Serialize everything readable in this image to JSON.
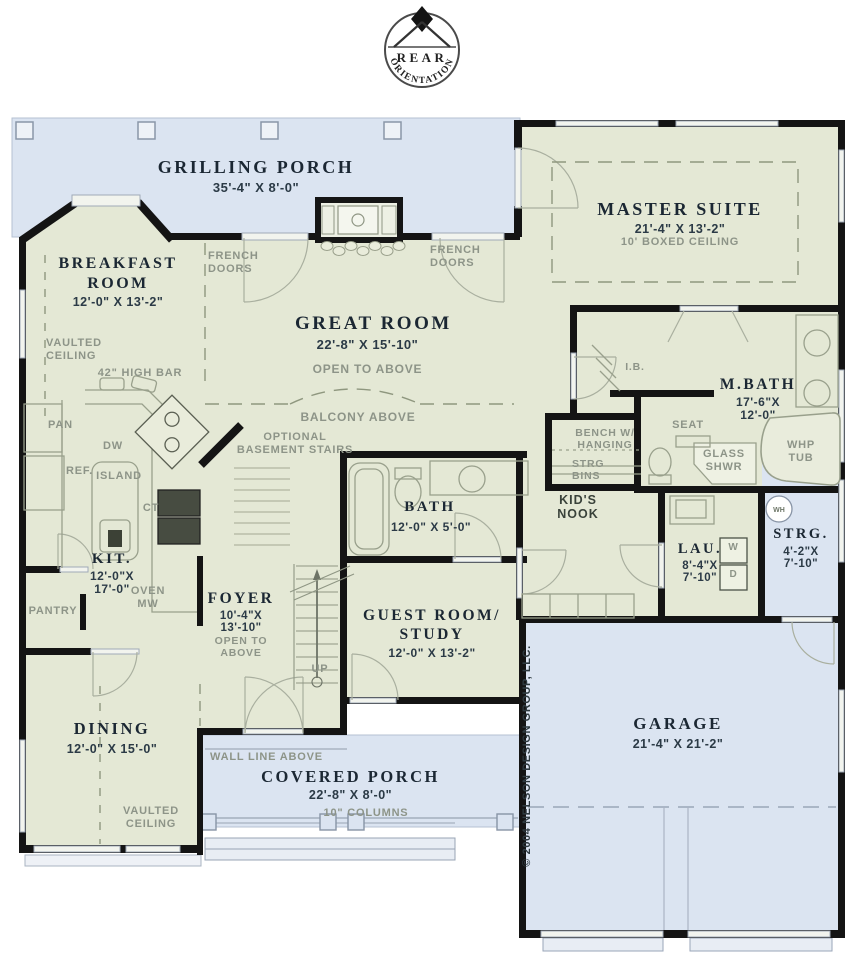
{
  "colors": {
    "porch_blue": "#dbe4f1",
    "room_green": "#e4e8d5",
    "wall_black": "#141414",
    "text_dark": "#1b2733",
    "annotation_gray": "#8d9488",
    "fixture_gray": "#99a08c",
    "window_gray": "#98a4b6"
  },
  "logo": {
    "top_label": "REAR",
    "bottom_label": "ORIENTATION"
  },
  "labels": {
    "grilling_porch_name": "GRILLING PORCH",
    "grilling_porch_dims": "35'-4\" X 8'-0\"",
    "french_left_1": "FRENCH",
    "french_left_2": "DOORS",
    "french_right_1": "FRENCH",
    "french_right_2": "DOORS",
    "breakfast_name_1": "BREAKFAST",
    "breakfast_name_2": "ROOM",
    "breakfast_dims": "12'-0\" X 13'-2\"",
    "breakfast_note_1": "VAULTED",
    "breakfast_note_2": "CEILING",
    "master_name": "MASTER SUITE",
    "master_dims": "21'-4\" X 13'-2\"",
    "master_note": "10' BOXED CEILING",
    "great_name": "GREAT ROOM",
    "great_dims": "22'-8\" X 15'-10\"",
    "great_note": "OPEN TO ABOVE",
    "balcony_note": "BALCONY ABOVE",
    "basement_note_1": "OPTIONAL",
    "basement_note_2": "BASEMENT STAIRS",
    "bar_note": "42\" HIGH BAR",
    "pan": "PAN",
    "dw": "DW",
    "ref": "REF.",
    "island": "ISLAND",
    "ct": "CT",
    "kit_name": "KIT.",
    "kit_dims_1": "12'-0\"X",
    "kit_dims_2": "17'-0\"",
    "oven_1": "OVEN",
    "oven_2": "MW",
    "pantry": "PANTRY",
    "bath_name": "BATH",
    "bath_dims": "12'-0\" X 5'-0\"",
    "ib": "I.B.",
    "mbath_name": "M.BATH",
    "mbath_dims_1": "17'-6\"X",
    "mbath_dims_2": "12'-0\"",
    "seat": "SEAT",
    "bench_1": "BENCH W/",
    "bench_2": "HANGING",
    "strgbins_1": "STRG",
    "strgbins_2": "BINS",
    "glass_1": "GLASS",
    "glass_2": "SHWR",
    "whp_1": "WHP",
    "whp_2": "TUB",
    "kids_1": "KID'S",
    "kids_2": "NOOK",
    "foyer_name": "FOYER",
    "foyer_dims_1": "10'-4\"X",
    "foyer_dims_2": "13'-10\"",
    "foyer_note_1": "OPEN TO",
    "foyer_note_2": "ABOVE",
    "up": "UP",
    "guest_name_1": "GUEST ROOM/",
    "guest_name_2": "STUDY",
    "guest_dims": "12'-0\" X 13'-2\"",
    "lau_name": "LAU.",
    "lau_dims_1": "8'-4\"X",
    "lau_dims_2": "7'-10\"",
    "washer": "W",
    "dryer": "D",
    "strg_name": "STRG.",
    "strg_dims_1": "4'-2\"X",
    "strg_dims_2": "7'-10\"",
    "wh": "WH",
    "dining_name": "DINING",
    "dining_dims": "12'-0\" X 15'-0\"",
    "dining_note_1": "VAULTED",
    "dining_note_2": "CEILING",
    "wall_line_note": "WALL LINE ABOVE",
    "porch_name": "COVERED PORCH",
    "porch_dims": "22'-8\" X 8'-0\"",
    "columns_note": "10\" COLUMNS",
    "garage_name": "GARAGE",
    "garage_dims": "21'-4\" X 21'-2\"",
    "copyright": "© 2004 NELSON DESIGN GROUP, LLC."
  }
}
